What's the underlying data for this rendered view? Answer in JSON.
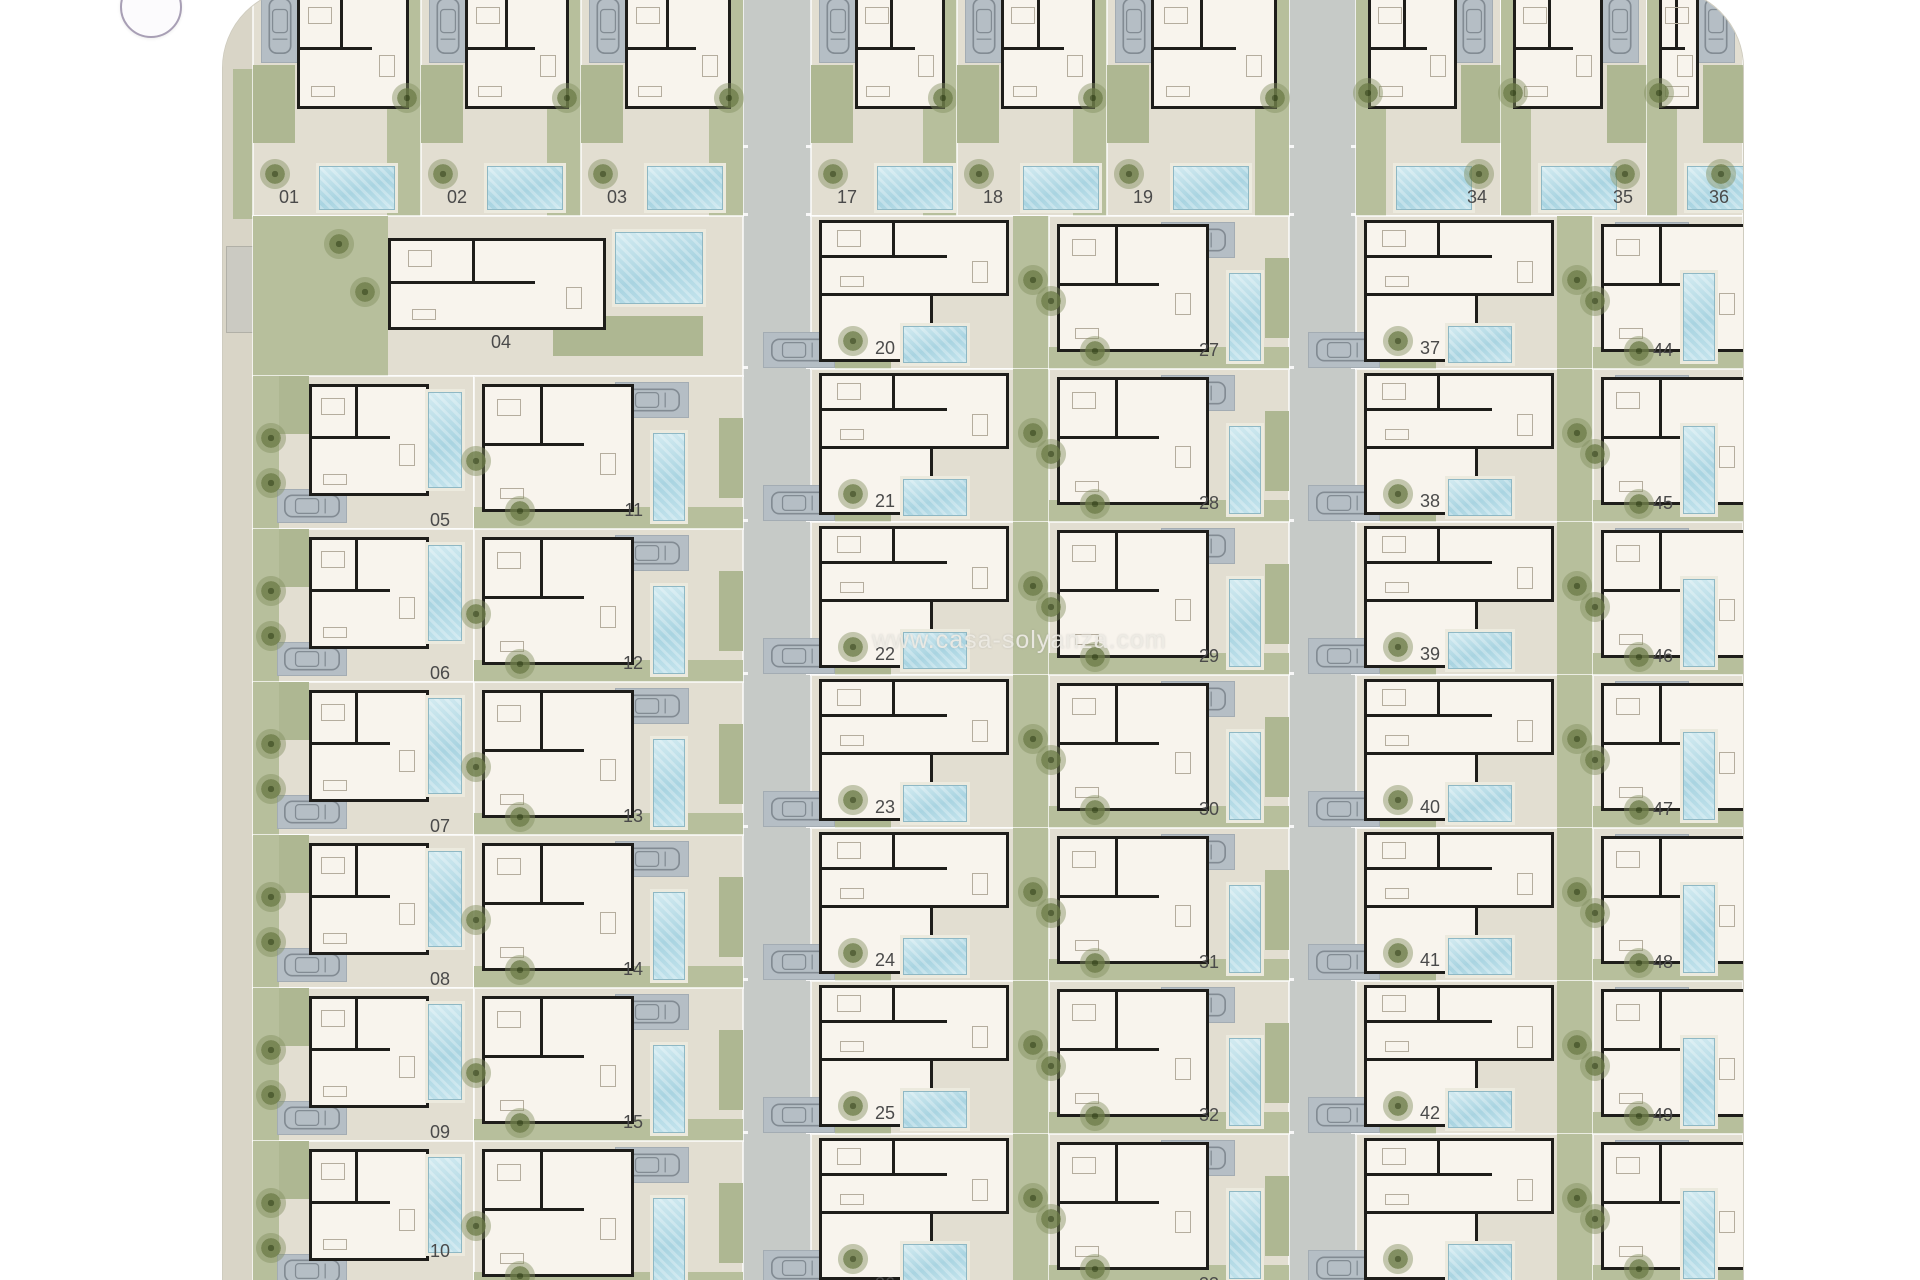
{
  "watermark": {
    "text": "www.casa-solyanza.com"
  },
  "nav_button": {
    "icon": "nav-arrow-icon"
  },
  "colors": {
    "page_background": "#ffffff",
    "site_ground": "#e4e0d3",
    "parcel_ground": "#e2ded1",
    "garden_green": "#b7bf9c",
    "road_gray": "#c6cac7",
    "driveway_gray": "#b5bec5",
    "pool_water": "#a9d4e1",
    "wall_black": "#1e1d1a",
    "room_white": "#f8f4ed",
    "plot_number_text": "#4a4a4a",
    "watermark_text": "#eceae1",
    "nav_button_border": "#a89fb5"
  },
  "site": {
    "plots": [
      {
        "label": "01",
        "type": "A",
        "x": 30,
        "y": 0,
        "w": 168,
        "h": 227
      },
      {
        "label": "02",
        "type": "A",
        "x": 198,
        "y": 0,
        "w": 160,
        "h": 227
      },
      {
        "label": "03",
        "type": "A",
        "x": 358,
        "y": 0,
        "w": 162,
        "h": 227
      },
      {
        "label": "17",
        "type": "A",
        "x": 588,
        "y": 0,
        "w": 146,
        "h": 227
      },
      {
        "label": "18",
        "type": "A",
        "x": 734,
        "y": 0,
        "w": 150,
        "h": 227
      },
      {
        "label": "19",
        "type": "A",
        "x": 884,
        "y": 0,
        "w": 182,
        "h": 227
      },
      {
        "label": "34",
        "type": "A2",
        "x": 1133,
        "y": 0,
        "w": 145,
        "h": 227
      },
      {
        "label": "35",
        "type": "A2",
        "x": 1278,
        "y": 0,
        "w": 146,
        "h": 227
      },
      {
        "label": "36",
        "type": "A2",
        "x": 1424,
        "y": 0,
        "w": 96,
        "h": 227
      },
      {
        "label": "04",
        "type": "E",
        "x": 30,
        "y": 227,
        "w": 490,
        "h": 160
      },
      {
        "label": "05",
        "type": "C",
        "x": 30,
        "y": 387,
        "w": 221,
        "h": 153
      },
      {
        "label": "06",
        "type": "C",
        "x": 30,
        "y": 540,
        "w": 221,
        "h": 153
      },
      {
        "label": "07",
        "type": "C",
        "x": 30,
        "y": 693,
        "w": 221,
        "h": 153
      },
      {
        "label": "08",
        "type": "C",
        "x": 30,
        "y": 846,
        "w": 221,
        "h": 153
      },
      {
        "label": "09",
        "type": "C",
        "x": 30,
        "y": 999,
        "w": 221,
        "h": 153
      },
      {
        "label": "10",
        "type": "C",
        "mod": "lab-up",
        "x": 30,
        "y": 1152,
        "w": 221,
        "h": 153
      },
      {
        "label": "11",
        "type": "P",
        "mod": "pool-in",
        "x": 251,
        "y": 387,
        "w": 269,
        "h": 153
      },
      {
        "label": "12",
        "type": "P",
        "mod": "pool-in",
        "x": 251,
        "y": 540,
        "w": 269,
        "h": 153
      },
      {
        "label": "13",
        "type": "P",
        "mod": "pool-in",
        "x": 251,
        "y": 693,
        "w": 269,
        "h": 153
      },
      {
        "label": "14",
        "type": "P",
        "mod": "pool-in",
        "x": 251,
        "y": 846,
        "w": 269,
        "h": 153
      },
      {
        "label": "15",
        "type": "P",
        "mod": "pool-in",
        "x": 251,
        "y": 999,
        "w": 269,
        "h": 153
      },
      {
        "label": "",
        "type": "P",
        "mod": "pool-in cut",
        "x": 251,
        "y": 1152,
        "w": 269,
        "h": 153
      },
      {
        "label": "20",
        "type": "D",
        "x": 588,
        "y": 227,
        "w": 238,
        "h": 153
      },
      {
        "label": "21",
        "type": "D",
        "x": 588,
        "y": 380,
        "w": 238,
        "h": 153
      },
      {
        "label": "22",
        "type": "D",
        "x": 588,
        "y": 533,
        "w": 238,
        "h": 153
      },
      {
        "label": "23",
        "type": "D",
        "x": 588,
        "y": 686,
        "w": 238,
        "h": 153
      },
      {
        "label": "24",
        "type": "D",
        "x": 588,
        "y": 839,
        "w": 238,
        "h": 153
      },
      {
        "label": "25",
        "type": "D",
        "x": 588,
        "y": 992,
        "w": 238,
        "h": 153
      },
      {
        "label": "26",
        "type": "D",
        "mod": "cut",
        "x": 588,
        "y": 1145,
        "w": 238,
        "h": 153
      },
      {
        "label": "27",
        "type": "P",
        "x": 826,
        "y": 227,
        "w": 240,
        "h": 153
      },
      {
        "label": "28",
        "type": "P",
        "x": 826,
        "y": 380,
        "w": 240,
        "h": 153
      },
      {
        "label": "29",
        "type": "P",
        "x": 826,
        "y": 533,
        "w": 240,
        "h": 153
      },
      {
        "label": "30",
        "type": "P",
        "x": 826,
        "y": 686,
        "w": 240,
        "h": 153
      },
      {
        "label": "31",
        "type": "P",
        "x": 826,
        "y": 839,
        "w": 240,
        "h": 153
      },
      {
        "label": "32",
        "type": "P",
        "x": 826,
        "y": 992,
        "w": 240,
        "h": 153
      },
      {
        "label": "33",
        "type": "P",
        "mod": "cut",
        "x": 826,
        "y": 1145,
        "w": 240,
        "h": 153
      },
      {
        "label": "37",
        "type": "D",
        "x": 1133,
        "y": 227,
        "w": 237,
        "h": 153
      },
      {
        "label": "38",
        "type": "D",
        "x": 1133,
        "y": 380,
        "w": 237,
        "h": 153
      },
      {
        "label": "39",
        "type": "D",
        "x": 1133,
        "y": 533,
        "w": 237,
        "h": 153
      },
      {
        "label": "40",
        "type": "D",
        "x": 1133,
        "y": 686,
        "w": 237,
        "h": 153
      },
      {
        "label": "41",
        "type": "D",
        "x": 1133,
        "y": 839,
        "w": 237,
        "h": 153
      },
      {
        "label": "42",
        "type": "D",
        "x": 1133,
        "y": 992,
        "w": 237,
        "h": 153
      },
      {
        "label": "",
        "type": "D",
        "mod": "cut",
        "x": 1133,
        "y": 1145,
        "w": 237,
        "h": 153
      },
      {
        "label": "44",
        "type": "P",
        "x": 1370,
        "y": 227,
        "w": 150,
        "h": 153
      },
      {
        "label": "45",
        "type": "P",
        "x": 1370,
        "y": 380,
        "w": 150,
        "h": 153
      },
      {
        "label": "46",
        "type": "P",
        "x": 1370,
        "y": 533,
        "w": 150,
        "h": 153
      },
      {
        "label": "47",
        "type": "P",
        "x": 1370,
        "y": 686,
        "w": 150,
        "h": 153
      },
      {
        "label": "48",
        "type": "P",
        "x": 1370,
        "y": 839,
        "w": 150,
        "h": 153
      },
      {
        "label": "49",
        "type": "P",
        "x": 1370,
        "y": 992,
        "w": 150,
        "h": 153
      },
      {
        "label": "",
        "type": "P",
        "mod": "cut",
        "x": 1370,
        "y": 1145,
        "w": 150,
        "h": 153
      }
    ]
  }
}
